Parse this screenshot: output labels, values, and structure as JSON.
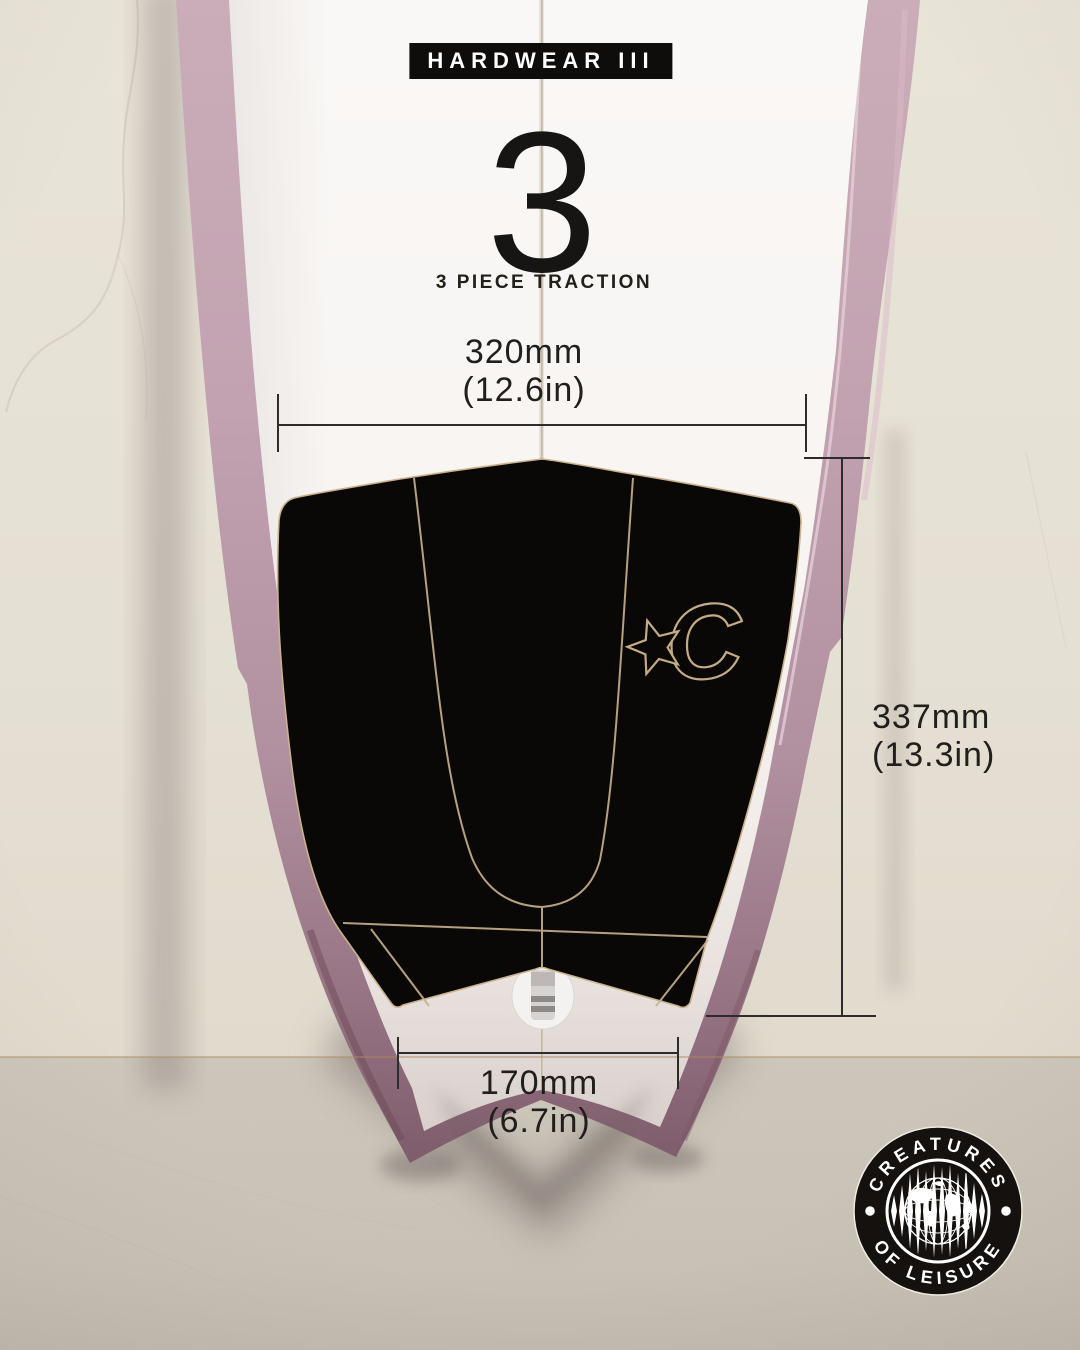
{
  "header": {
    "badge": "HARDWEAR III",
    "number": "3",
    "subtitle": "3 PIECE TRACTION"
  },
  "dimensions": {
    "width": {
      "metric": "320mm",
      "imperial": "(12.6in)"
    },
    "height": {
      "metric": "337mm",
      "imperial": "(13.3in)"
    },
    "tail": {
      "metric": "170mm",
      "imperial": "(6.7in)"
    }
  },
  "brand": {
    "arc_top": "CREATURES",
    "arc_bottom": "OF LEISURE",
    "pad_logo": "C"
  },
  "colors": {
    "badge_black": "#0e0d0c",
    "pad_black": "#0a0807",
    "pad_outline_tan": "#c9b28c",
    "rail_pink": "#bfa0ae",
    "deck_white": "#f7f4f2",
    "wall_beige": "#e6e1d5",
    "floor_beige": "#cbc5b9",
    "seam_tan": "#b08a5f",
    "dimension_line": "#2e2c2a"
  }
}
